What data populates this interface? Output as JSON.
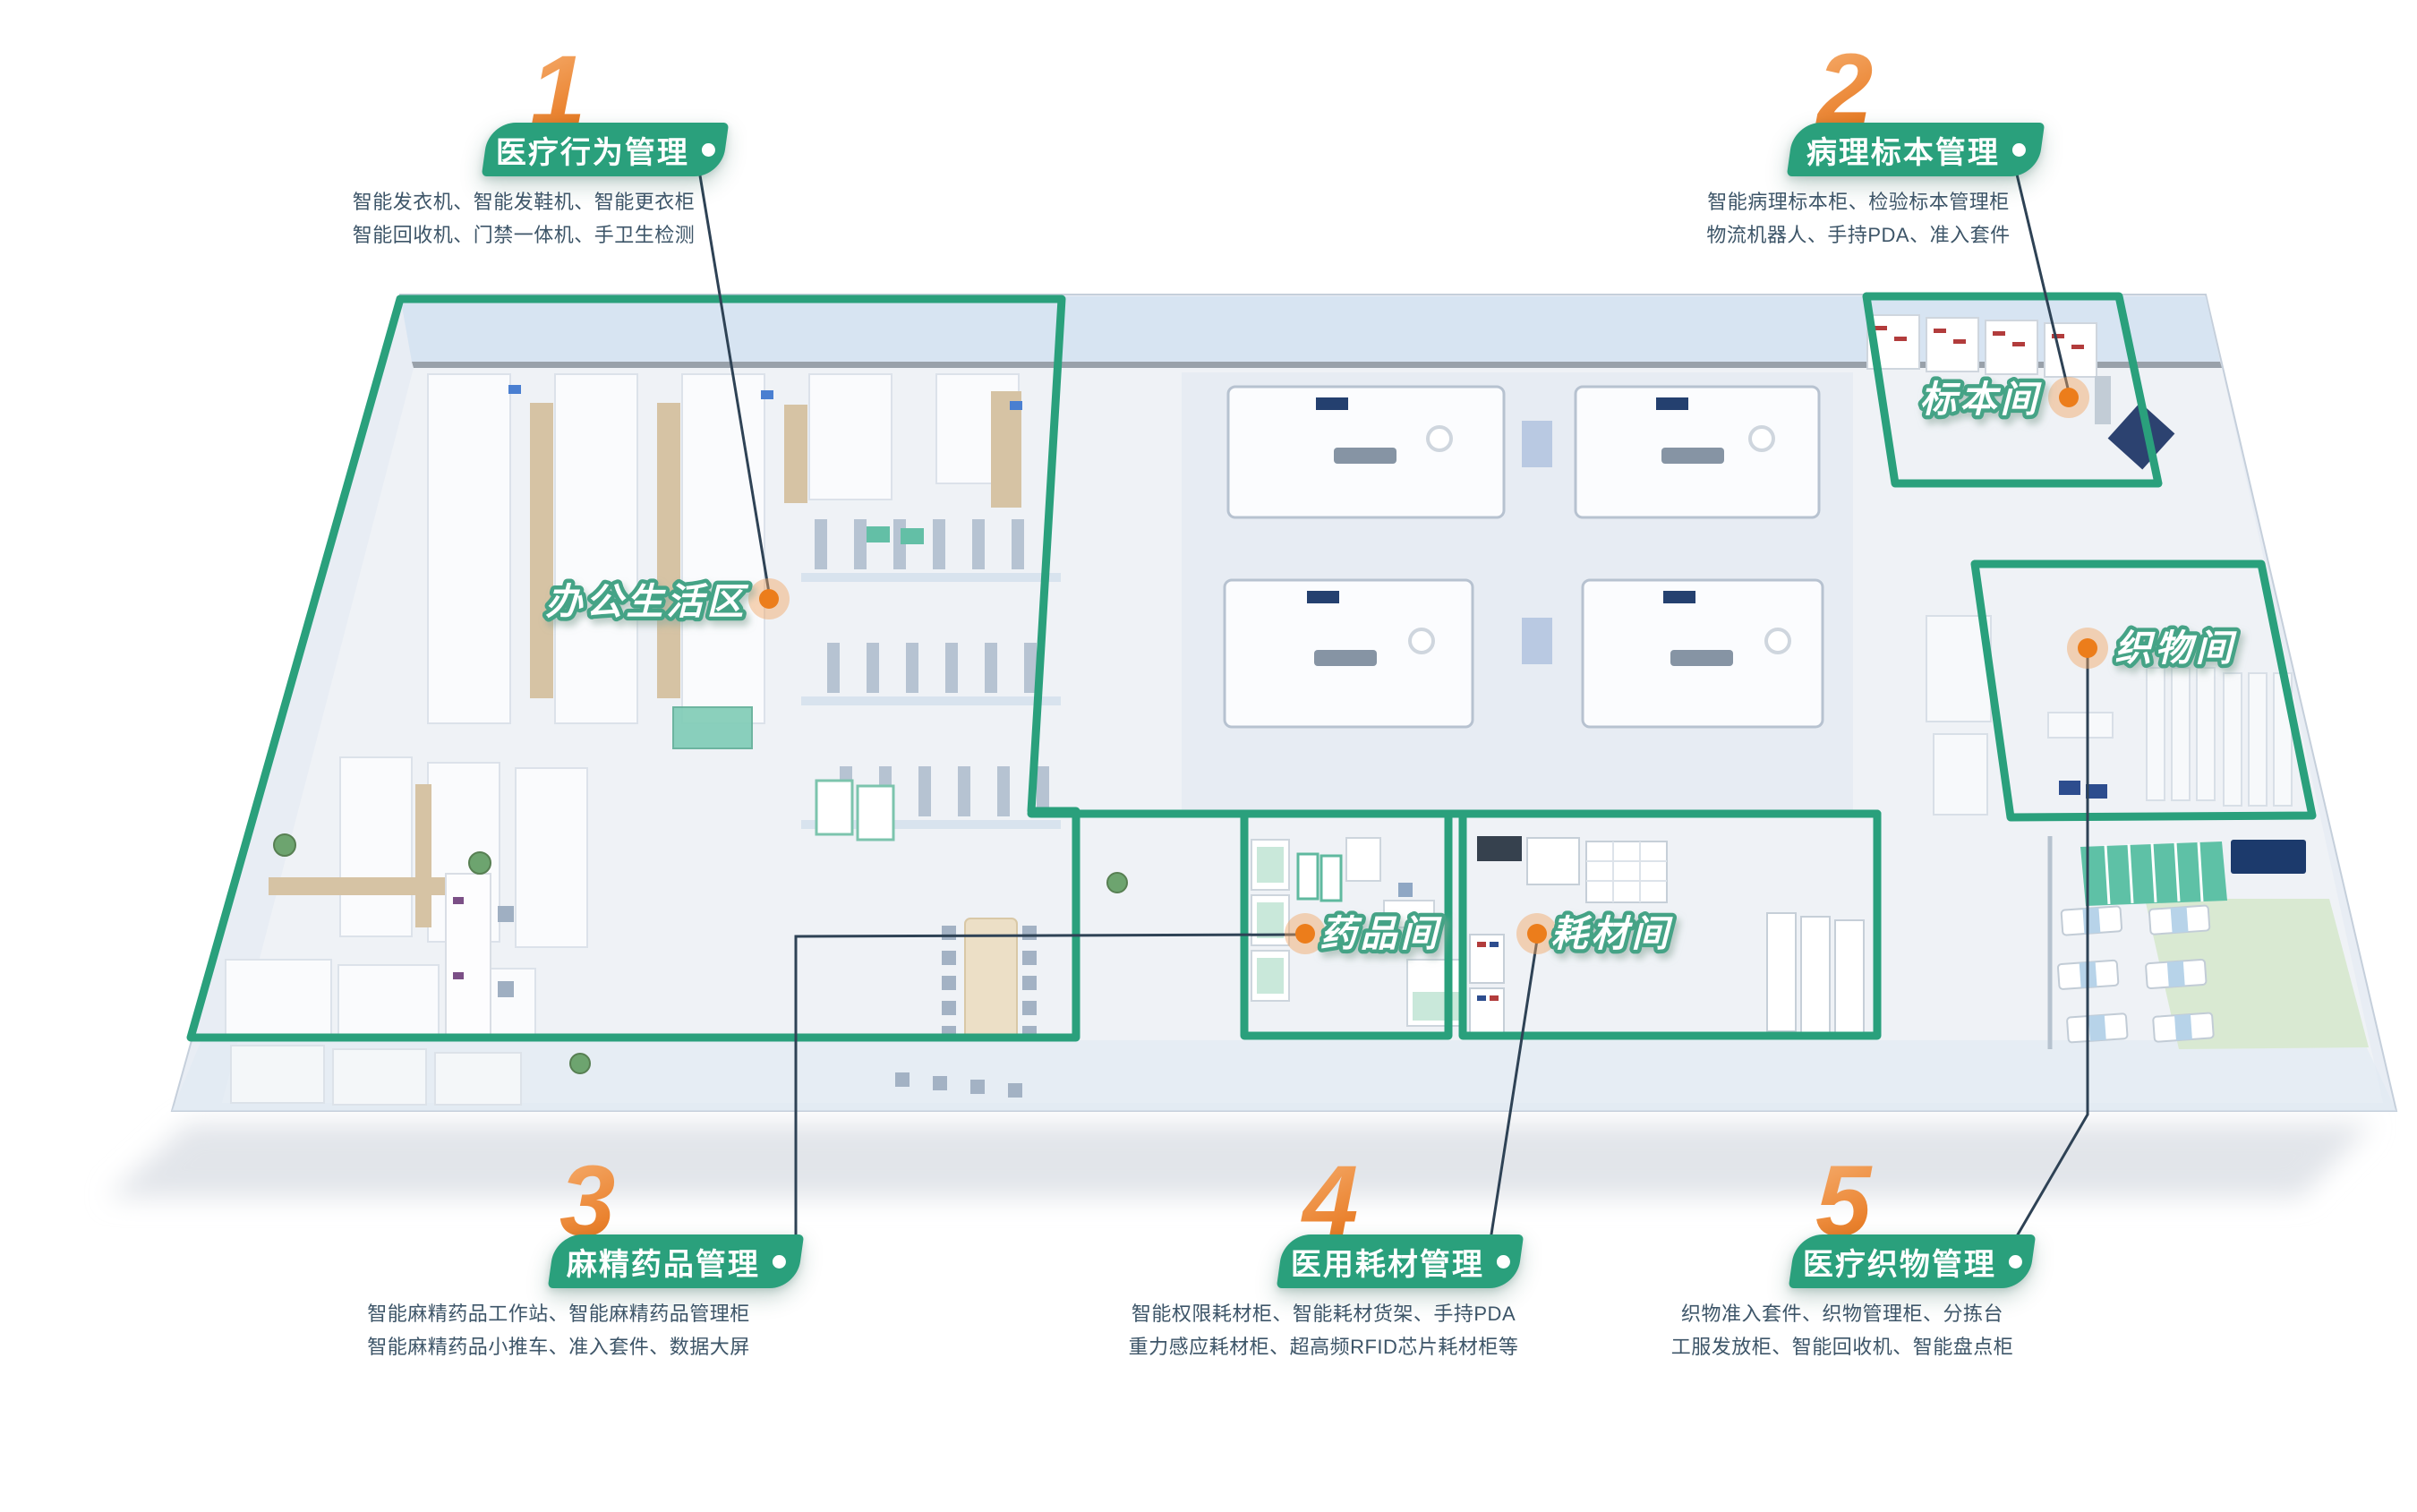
{
  "palette": {
    "green": "#2aa07c",
    "zone_label_stroke": "#45a386",
    "orange": "#ec7d1b",
    "orange_light": "#f6b274",
    "text_dark": "#3d5568",
    "connector": "#2e4255",
    "floor": "#eff2f6",
    "wall_blue": "#d7e4f2"
  },
  "callouts": [
    {
      "number": "1",
      "title": "医疗行为管理",
      "desc": [
        "智能发衣机、智能发鞋机、智能更衣柜",
        "智能回收机、门禁一体机、手卫生检测"
      ]
    },
    {
      "number": "2",
      "title": "病理标本管理",
      "desc": [
        "智能病理标本柜、检验标本管理柜",
        "物流机器人、手持PDA、准入套件"
      ]
    },
    {
      "number": "3",
      "title": "麻精药品管理",
      "desc": [
        "智能麻精药品工作站、智能麻精药品管理柜",
        "智能麻精药品小推车、准入套件、数据大屏"
      ]
    },
    {
      "number": "4",
      "title": "医用耗材管理",
      "desc": [
        "智能权限耗材柜、智能耗材货架、手持PDA",
        "重力感应耗材柜、超高频RFID芯片耗材柜等"
      ]
    },
    {
      "number": "5",
      "title": "医疗织物管理",
      "desc": [
        "织物准入套件、织物管理柜、分拣台",
        "工服发放柜、智能回收机、智能盘点柜"
      ]
    }
  ],
  "zones": [
    {
      "label": "办公生活区"
    },
    {
      "label": "标本间"
    },
    {
      "label": "织物间"
    },
    {
      "label": "药品间"
    },
    {
      "label": "耗材间"
    }
  ]
}
